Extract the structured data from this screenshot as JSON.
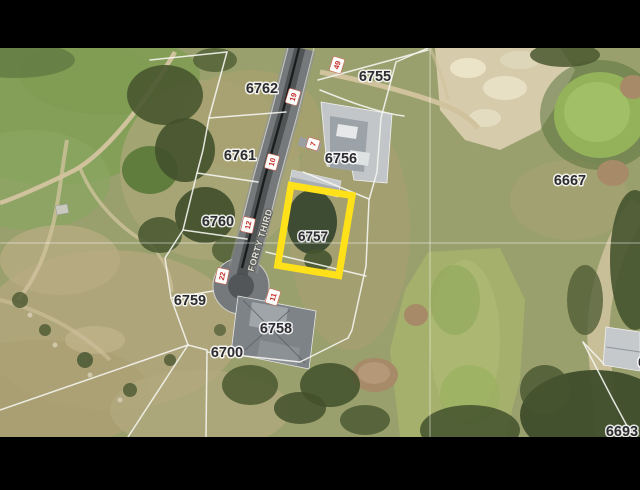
{
  "map": {
    "description": "Aerial parcel map with highlighted lot",
    "street": {
      "name": "FORTY THIRD"
    },
    "highlight": {
      "parcel": "6757",
      "color": "#ffe11a"
    },
    "colors": {
      "letterbox": "#000000",
      "highlight": "#ffe11a",
      "parcel_line": "#f4f4ee",
      "parcel_label_text": "#2b2b30",
      "road_marker_text": "#c62828",
      "road_asphalt": "#76797c"
    },
    "parcels": [
      {
        "label": "6762",
        "x": 262,
        "y": 88
      },
      {
        "label": "6761",
        "x": 240,
        "y": 155
      },
      {
        "label": "6760",
        "x": 218,
        "y": 221
      },
      {
        "label": "6759",
        "x": 190,
        "y": 300
      },
      {
        "label": "6700",
        "x": 227,
        "y": 352
      },
      {
        "label": "6758",
        "x": 276,
        "y": 328
      },
      {
        "label": "6757",
        "x": 313,
        "y": 237,
        "highlighted": true
      },
      {
        "label": "6756",
        "x": 341,
        "y": 158
      },
      {
        "label": "6755",
        "x": 375,
        "y": 76
      },
      {
        "label": "6667",
        "x": 570,
        "y": 180
      },
      {
        "label": "6693",
        "x": 622,
        "y": 431
      },
      {
        "label": "6",
        "x": 642,
        "y": 363,
        "partial": true
      }
    ],
    "road_markers": [
      {
        "value": "49",
        "x": 337,
        "y": 65
      },
      {
        "value": "19",
        "x": 293,
        "y": 97
      },
      {
        "value": "7",
        "x": 313,
        "y": 144
      },
      {
        "value": "10",
        "x": 272,
        "y": 162
      },
      {
        "value": "12",
        "x": 248,
        "y": 225
      },
      {
        "value": "22",
        "x": 222,
        "y": 276
      },
      {
        "value": "11",
        "x": 273,
        "y": 297
      }
    ]
  }
}
